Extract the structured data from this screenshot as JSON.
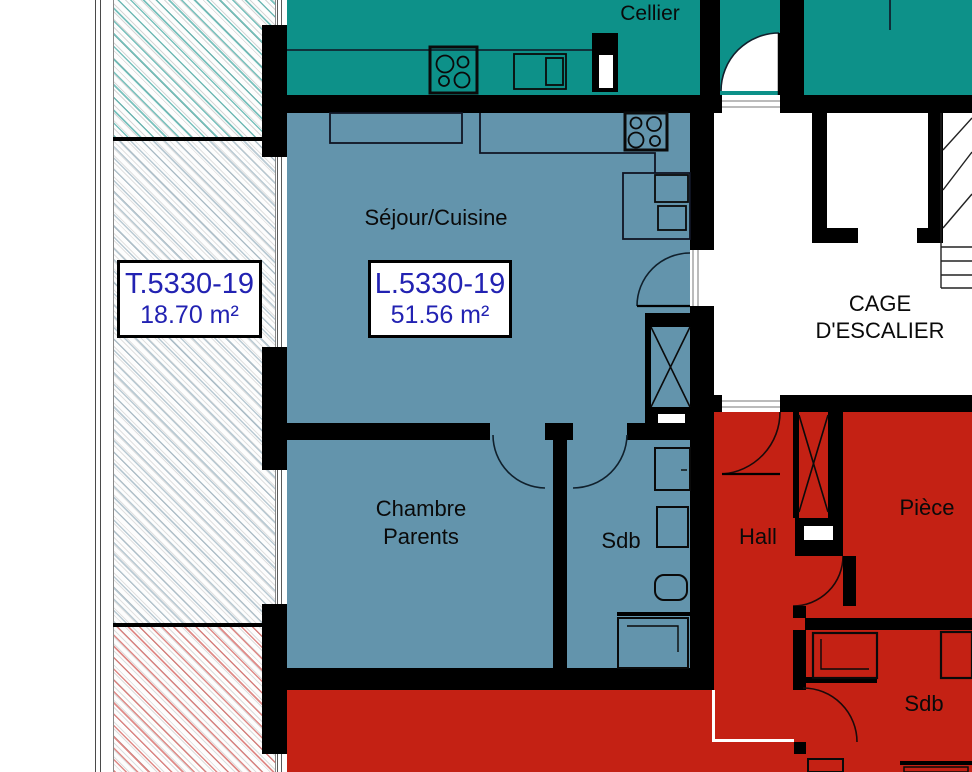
{
  "colors": {
    "teal": "#0D9189",
    "blue": "#6394AC",
    "red": "#C42114",
    "wall": "#000000",
    "label_blue": "#2222B2",
    "room_text": "#0A0A0A"
  },
  "rooms": {
    "cellier": "Cellier",
    "sejour_cuisine": "Séjour/Cuisine",
    "cage_escalier": {
      "line1": "CAGE",
      "line2": "D'ESCALIER"
    },
    "chambre_parents": {
      "line1": "Chambre",
      "line2": "Parents"
    },
    "sdb_blue": "Sdb",
    "hall": "Hall",
    "piece": "Pièce",
    "sdb_red": "Sdb"
  },
  "units": {
    "terrace": {
      "code": "T.5330-19",
      "area": "18.70 m²"
    },
    "apartment": {
      "code": "L.5330-19",
      "area": "51.56 m²"
    }
  }
}
